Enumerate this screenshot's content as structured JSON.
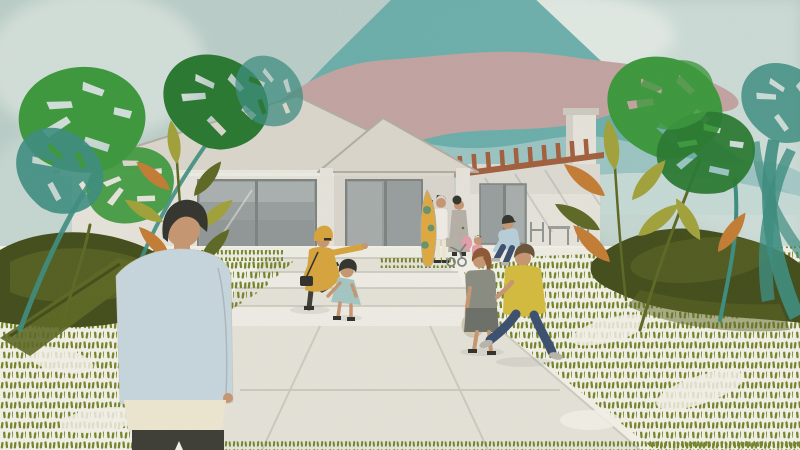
{
  "scene": {
    "title": "Watercolor-collage illustration: single-storey house with gabled entry, teal mountain backdrop, tropical plants and people in the front yard",
    "style": "watercolor collage illustration",
    "elements": {
      "sky": "pale textured teal sky with light washes",
      "mountain": "large teal mountain with dusty pink band and lighter foothills",
      "house": "white single-storey house with main gable roof, gabled entry porch, picture window, chimney and timber pergola patio",
      "plants": "monstera leaves, teal fronds and rubber-plant foliage framing both sides",
      "ground": "cream lawn drawn with green dash texture, concrete steps and widening walkway",
      "figures": [
        "man in pale blue jacket seen from behind (foreground)",
        "woman in yellow raincoat and hat pointing toward the house",
        "girl in teal dress stepping up",
        "woman with auburn ponytail carrying a beige bag",
        "man in yellow t-shirt and navy jeans walking",
        "man seated on the patio edge",
        "person in floral kimono with pink bag and stroller",
        "person in white beside a yellow surfboard"
      ]
    }
  },
  "palette": {
    "sky_base": "#bccfca",
    "sky_wash": "#d3e1dc",
    "sky_light": "#e9efe9",
    "mountain_teal": "#68aeab",
    "mountain_pink": "#c4a5a3",
    "foothill": "#a2c9c6",
    "wall": "#e8e5dd",
    "wall_shade": "#cfccc2",
    "roof": "#dcd8ce",
    "roof_edge": "#b3afa3",
    "glass": "#9aa0a0",
    "glass_light": "#c4c8c6",
    "frame": "#7f8582",
    "wood": "#a4613f",
    "porch": "#f0eee6",
    "path": "#e7e4da",
    "path_shade": "#c9c6bb",
    "lawn_bg": "#f5f3e9",
    "dash": "#76882e",
    "bush_dark": "#454f1d",
    "bush_mid": "#5f6a26",
    "leaf_green": "#3e9a3e",
    "leaf_deep": "#2b7a33",
    "leaf_teal": "#3f8f82",
    "leaf_olive": "#a3a33c",
    "leaf_orange": "#c57e36",
    "skin": "#c89873",
    "hair_dark": "#35362f",
    "hair_brown": "#6d543a",
    "hair_auburn": "#8e5a36",
    "jacket": "#c9d8e0",
    "shirt_cream": "#efe9d3",
    "pants_dark": "#3f3f38",
    "coat_yellow": "#d9a63e",
    "dress_teal": "#a7c8c6",
    "top_grey": "#8b8d83",
    "skirt_grey": "#6e716b",
    "tee_yellow": "#d6bc3f",
    "jeans": "#3c5170",
    "shirt_blue": "#b9d0dc",
    "shoe": "#b9b6ae",
    "bag_dark": "#33322e",
    "bag_beige": "#d6c9ac",
    "board_yellow": "#e2aa41",
    "kimono": "#b7b2a9",
    "pink": "#e79fae"
  }
}
